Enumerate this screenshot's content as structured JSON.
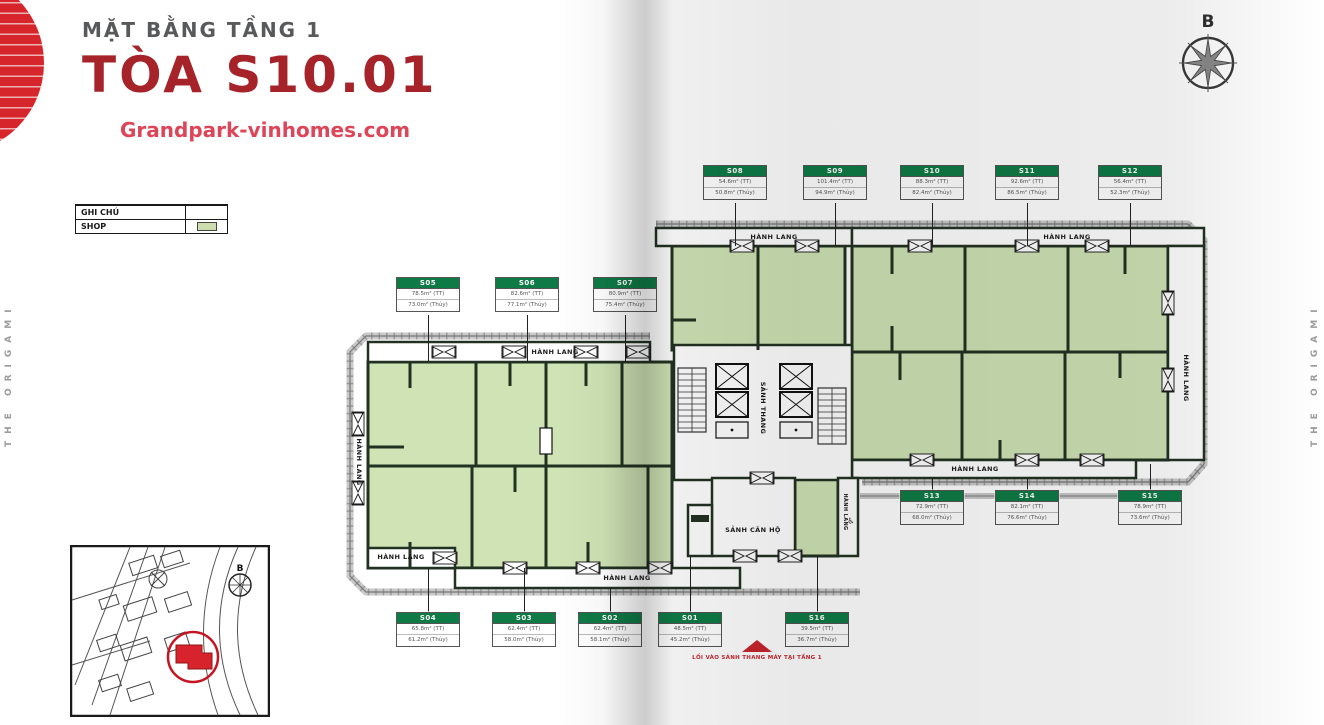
{
  "page": {
    "subtitle": "MẶT BẰNG TẦNG 1",
    "title": "TÒA S10.01",
    "website": "Grandpark-vinhomes.com",
    "side_text": "THE ORIGAMI",
    "compass_label": "B",
    "entrance_note": "LỐI VÀO SẢNH THANG MÁY TẠI TẦNG 1"
  },
  "legend": {
    "title": "GHI CHÚ",
    "shop_label": "SHOP",
    "shop_color": "#cdddae"
  },
  "colors": {
    "title_red": "#a6232a",
    "accent_red": "#d6252b",
    "unit_green": "#cfe3b5",
    "unit_header_green": "#0e7b46",
    "wall_dark": "#223222"
  },
  "plan": {
    "units": [
      {
        "id": "S01",
        "area1": "48.5m² (TT)",
        "area2": "45.2m² (Thủy)",
        "lx": 690,
        "ly1": 556,
        "ly2": 612,
        "y": 612
      },
      {
        "id": "S02",
        "area1": "62.4m² (TT)",
        "area2": "58.1m² (Thủy)",
        "lx": 610,
        "ly1": 588,
        "ly2": 612,
        "y": 612
      },
      {
        "id": "S03",
        "area1": "62.4m² (TT)",
        "area2": "58.0m² (Thủy)",
        "lx": 524,
        "ly1": 568,
        "ly2": 612,
        "y": 612
      },
      {
        "id": "S04",
        "area1": "65.8m² (TT)",
        "area2": "61.2m² (Thủy)",
        "lx": 428,
        "ly1": 568,
        "ly2": 612,
        "y": 612
      },
      {
        "id": "S05",
        "area1": "78.5m² (TT)",
        "area2": "73.0m² (Thủy)",
        "lx": 428,
        "ly1": 315,
        "ly2": 362,
        "y": 277
      },
      {
        "id": "S06",
        "area1": "82.6m² (TT)",
        "area2": "77.1m² (Thủy)",
        "lx": 527,
        "ly1": 315,
        "ly2": 362,
        "y": 277
      },
      {
        "id": "S07",
        "area1": "80.9m² (TT)",
        "area2": "75.4m² (Thủy)",
        "lx": 625,
        "ly1": 315,
        "ly2": 362,
        "y": 277
      },
      {
        "id": "S08",
        "area1": "54.6m² (TT)",
        "area2": "50.8m² (Thủy)",
        "lx": 735,
        "ly1": 203,
        "ly2": 246,
        "y": 165
      },
      {
        "id": "S09",
        "area1": "101.4m² (TT)",
        "area2": "94.9m² (Thủy)",
        "lx": 835,
        "ly1": 203,
        "ly2": 246,
        "y": 165
      },
      {
        "id": "S10",
        "area1": "88.3m² (TT)",
        "area2": "82.4m² (Thủy)",
        "lx": 932,
        "ly1": 203,
        "ly2": 246,
        "y": 165
      },
      {
        "id": "S11",
        "area1": "92.6m² (TT)",
        "area2": "86.5m² (Thủy)",
        "lx": 1027,
        "ly1": 203,
        "ly2": 246,
        "y": 165
      },
      {
        "id": "S12",
        "area1": "56.4m² (TT)",
        "area2": "52.3m² (Thủy)",
        "lx": 1130,
        "ly1": 203,
        "ly2": 246,
        "y": 165
      },
      {
        "id": "S13",
        "area1": "72.9m² (TT)",
        "area2": "68.0m² (Thủy)",
        "lx": 932,
        "ly1": 478,
        "ly2": 490,
        "y": 490
      },
      {
        "id": "S14",
        "area1": "82.1m² (TT)",
        "area2": "76.6m² (Thủy)",
        "lx": 1027,
        "ly1": 478,
        "ly2": 490,
        "y": 490
      },
      {
        "id": "S15",
        "area1": "78.9m² (TT)",
        "area2": "73.6m² (Thủy)",
        "lx": 1150,
        "ly1": 464,
        "ly2": 490,
        "y": 490
      },
      {
        "id": "S16",
        "area1": "39.5m² (TT)",
        "area2": "36.7m² (Thủy)",
        "lx": 817,
        "ly1": 556,
        "ly2": 612,
        "y": 612
      }
    ],
    "labels": [
      {
        "text": "HÀNH LANG",
        "x": 555,
        "y": 352,
        "name": "corridor-label"
      },
      {
        "text": "HÀNH LANG",
        "x": 359,
        "y": 462,
        "v": true,
        "name": "corridor-label"
      },
      {
        "text": "HÀNH LANG",
        "x": 401,
        "y": 557,
        "name": "corridor-label"
      },
      {
        "text": "HÀNH LANG",
        "x": 627,
        "y": 578,
        "name": "corridor-label"
      },
      {
        "text": "HÀNH LANG",
        "x": 774,
        "y": 237,
        "name": "corridor-label"
      },
      {
        "text": "HÀNH LANG",
        "x": 1067,
        "y": 237,
        "name": "corridor-label"
      },
      {
        "text": "HÀNH LANG",
        "x": 975,
        "y": 469,
        "name": "corridor-label"
      },
      {
        "text": "HÀNH LANG",
        "x": 1186,
        "y": 378,
        "v": true,
        "name": "corridor-label"
      },
      {
        "text": "HÀNH LANG",
        "x": 845,
        "y": 512,
        "v": true,
        "small": true,
        "name": "corridor-label"
      },
      {
        "text": "SẢNH THANG",
        "x": 763,
        "y": 408,
        "v": true,
        "name": "elevator-lobby-label"
      },
      {
        "text": "SẢNH CĂN HỘ",
        "x": 753,
        "y": 530,
        "name": "apartment-lobby-label"
      },
      {
        "text": "♿",
        "x": 851,
        "y": 521,
        "icon": true,
        "name": "accessibility-icon"
      }
    ]
  }
}
